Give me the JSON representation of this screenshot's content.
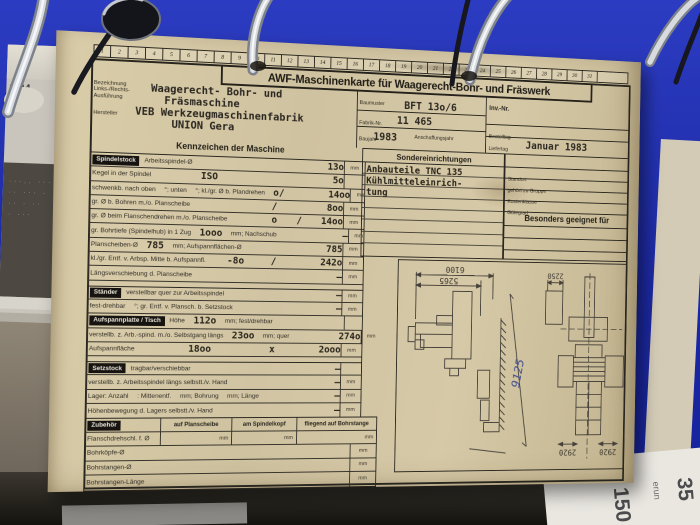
{
  "binder": {
    "page_tab_label": "2/84"
  },
  "underlying_paper": {
    "rotated_texts": [
      "35",
      "erun",
      "150"
    ]
  },
  "card": {
    "number_strip": [
      "1",
      "2",
      "3",
      "4",
      "5",
      "6",
      "7",
      "8",
      "9",
      "10",
      "11",
      "12",
      "13",
      "14",
      "15",
      "16",
      "17",
      "18",
      "19",
      "20",
      "21",
      "22",
      "23",
      "24",
      "25",
      "26",
      "27",
      "28",
      "29",
      "30",
      "31"
    ],
    "title": "AWF-Maschinenkarte für Waagerecht-Bohr- und Fräswerk",
    "header": {
      "left": {
        "label_line1": "Bezeichnung",
        "label_line2": "Links-/Rechts-",
        "label_line3": "Ausführung",
        "hersteller_label": "Hersteller",
        "typed_lines": [
          "Waagerecht- Bohr- und",
          "Fräsmaschine",
          "VEB Werkzeugmaschinenfabrik",
          "UNION Gera"
        ]
      },
      "middle": {
        "baumuster_label": "Baumuster",
        "baumuster_value": "BFT 13o/6",
        "fabrik_label": "Fabrik-Nr.",
        "fabrik_value": "11 465",
        "baujahr_label": "Baujahr",
        "baujahr_value": "1983",
        "anschaffung_label": "Anschaffungsjahr"
      },
      "right": {
        "inv_label": "Inv.-Nr.",
        "bestelltag_label": "Bestelltag",
        "liefertag_label": "Liefertag",
        "liefertag_value": "Januar 1983"
      }
    },
    "kennzeichen_header": "Kennzeichen der Maschine",
    "spec_rows": [
      {
        "tab": "Spindelstock",
        "parts": [
          {
            "k": "p",
            "s": "Arbeitsspindel-Ø"
          }
        ],
        "value": "13o",
        "unit": "mm"
      },
      {
        "parts": [
          {
            "k": "p",
            "s": "Kegel in der Spindel"
          },
          {
            "k": "t",
            "s": "ISO",
            "push": true
          }
        ],
        "value": "5o",
        "unit": ""
      },
      {
        "parts": [
          {
            "k": "p",
            "s": "schwenkb. nach oben"
          },
          {
            "k": "p",
            "s": "°; unten"
          },
          {
            "k": "p",
            "s": "°; kl./gr. Ø b. Plandrehen"
          },
          {
            "k": "t",
            "s": "o"
          }
        ],
        "value": "/ 14oo",
        "unit": "mm"
      },
      {
        "parts": [
          {
            "k": "p",
            "s": "gr. Ø b. Bohren m./o. Planscheibe"
          }
        ],
        "value": "/ 8oo",
        "unit": "mm"
      },
      {
        "parts": [
          {
            "k": "p",
            "s": "gr. Ø beim Flanschendrehen m./o. Planscheibe"
          }
        ],
        "value": "o / 14oo",
        "unit": "mm"
      },
      {
        "parts": [
          {
            "k": "p",
            "s": "gr. Bohrtiefe (Spindelhub) in 1 Zug"
          },
          {
            "k": "t",
            "s": "1ooo"
          },
          {
            "k": "p",
            "s": "mm; Nachschub"
          }
        ],
        "value": "–",
        "unit": "mm"
      },
      {
        "parts": [
          {
            "k": "p",
            "s": "Planscheiben-Ø"
          },
          {
            "k": "t",
            "s": "785"
          },
          {
            "k": "p",
            "s": "mm; Aufspannflächen-Ø"
          }
        ],
        "value": "785",
        "unit": "mm"
      },
      {
        "parts": [
          {
            "k": "p",
            "s": "kl./gr. Entf. v. Arbsp. Mitte b. Aufspannfl."
          },
          {
            "k": "t",
            "s": "-8o",
            "push": true
          }
        ],
        "value": "/ 242o",
        "unit": "mm"
      },
      {
        "parts": [
          {
            "k": "p",
            "s": "Längsverschiebung d. Planscheibe"
          }
        ],
        "value": "–",
        "unit": "mm"
      },
      {
        "sep": true,
        "tab": "Ständer",
        "parts": [
          {
            "k": "p",
            "s": "verstellbar quer zur Arbeitsspindel"
          }
        ],
        "value": "–",
        "unit": "mm"
      },
      {
        "parts": [
          {
            "k": "p",
            "s": "fest-drehbar"
          },
          {
            "k": "p",
            "s": "°; gr. Entf. v. Plansch. b. Setzstock"
          }
        ],
        "value": "–",
        "unit": "mm"
      },
      {
        "tab": "Aufspannplatte / Tisch",
        "parts": [
          {
            "k": "p",
            "s": "Höhe"
          },
          {
            "k": "t",
            "s": "112o"
          },
          {
            "k": "p",
            "s": "mm; fest/drehbar"
          }
        ],
        "value": "",
        "unit": ""
      },
      {
        "parts": [
          {
            "k": "p",
            "s": "verstellb. z. Arb.-spind. m./o. Selbstgang längs"
          },
          {
            "k": "t",
            "s": "23oo"
          },
          {
            "k": "p",
            "s": "mm; quer"
          }
        ],
        "value": "274o",
        "unit": "mm"
      },
      {
        "parts": [
          {
            "k": "p",
            "s": "Aufspannfläche"
          },
          {
            "k": "t",
            "s": "18oo",
            "push": true
          }
        ],
        "value": "x 2ooo",
        "unit": "mm"
      },
      {
        "sep": true,
        "tab": "Setzstock",
        "parts": [
          {
            "k": "p",
            "s": "tragbar/verschiebbar"
          }
        ],
        "value": "–",
        "unit": ""
      },
      {
        "parts": [
          {
            "k": "p",
            "s": "verstellb. z. Arbeitsspindel längs selbstt./v. Hand"
          }
        ],
        "value": "–",
        "unit": "mm"
      },
      {
        "parts": [
          {
            "k": "p",
            "s": "Lager: Anzahl"
          },
          {
            "k": "p",
            "s": ": Mittenentf."
          },
          {
            "k": "p",
            "s": "mm; Bohrung"
          },
          {
            "k": "p",
            "s": "mm; Länge"
          }
        ],
        "value": "–",
        "unit": "mm"
      },
      {
        "parts": [
          {
            "k": "p",
            "s": "Höhenbewegung d. Lagers selbstt./v. Hand"
          }
        ],
        "value": "–",
        "unit": "mm"
      }
    ],
    "sonder": {
      "header": "Sondereinrichtungen",
      "typed_lines": [
        "Anbauteile TNC 135",
        "Kühlmitteleinrich-",
        "tung"
      ]
    },
    "right_col": {
      "rows": [
        "Standort",
        "gehört zu Gruppe",
        "Kostenklasse",
        "Gütegrad"
      ],
      "besonders_header": "Besonders geeignet für"
    },
    "zubehoer": {
      "tab": "Zubehör",
      "col_headers": [
        "auf Planscheibe",
        "am Spindelkopf",
        "fliegend auf Bohrstange"
      ],
      "first_row_label": "Flanschdrehschl. f. Ø",
      "first_row_units": [
        "mm",
        "mm",
        "mm"
      ],
      "tail_rows": [
        {
          "label": "Bohrköpfe-Ø",
          "unit": "mm"
        },
        {
          "label": "Bohrstangen-Ø",
          "unit": "mm"
        },
        {
          "label": "Bohrstangen-Länge",
          "unit": "mm"
        }
      ]
    },
    "drawing": {
      "dim_top1": "6100",
      "dim_top2": "5265",
      "dim_diag": "9125",
      "dim_right_top": "2250",
      "dim_bot_left": "2920",
      "dim_bot_right": "2920"
    }
  }
}
